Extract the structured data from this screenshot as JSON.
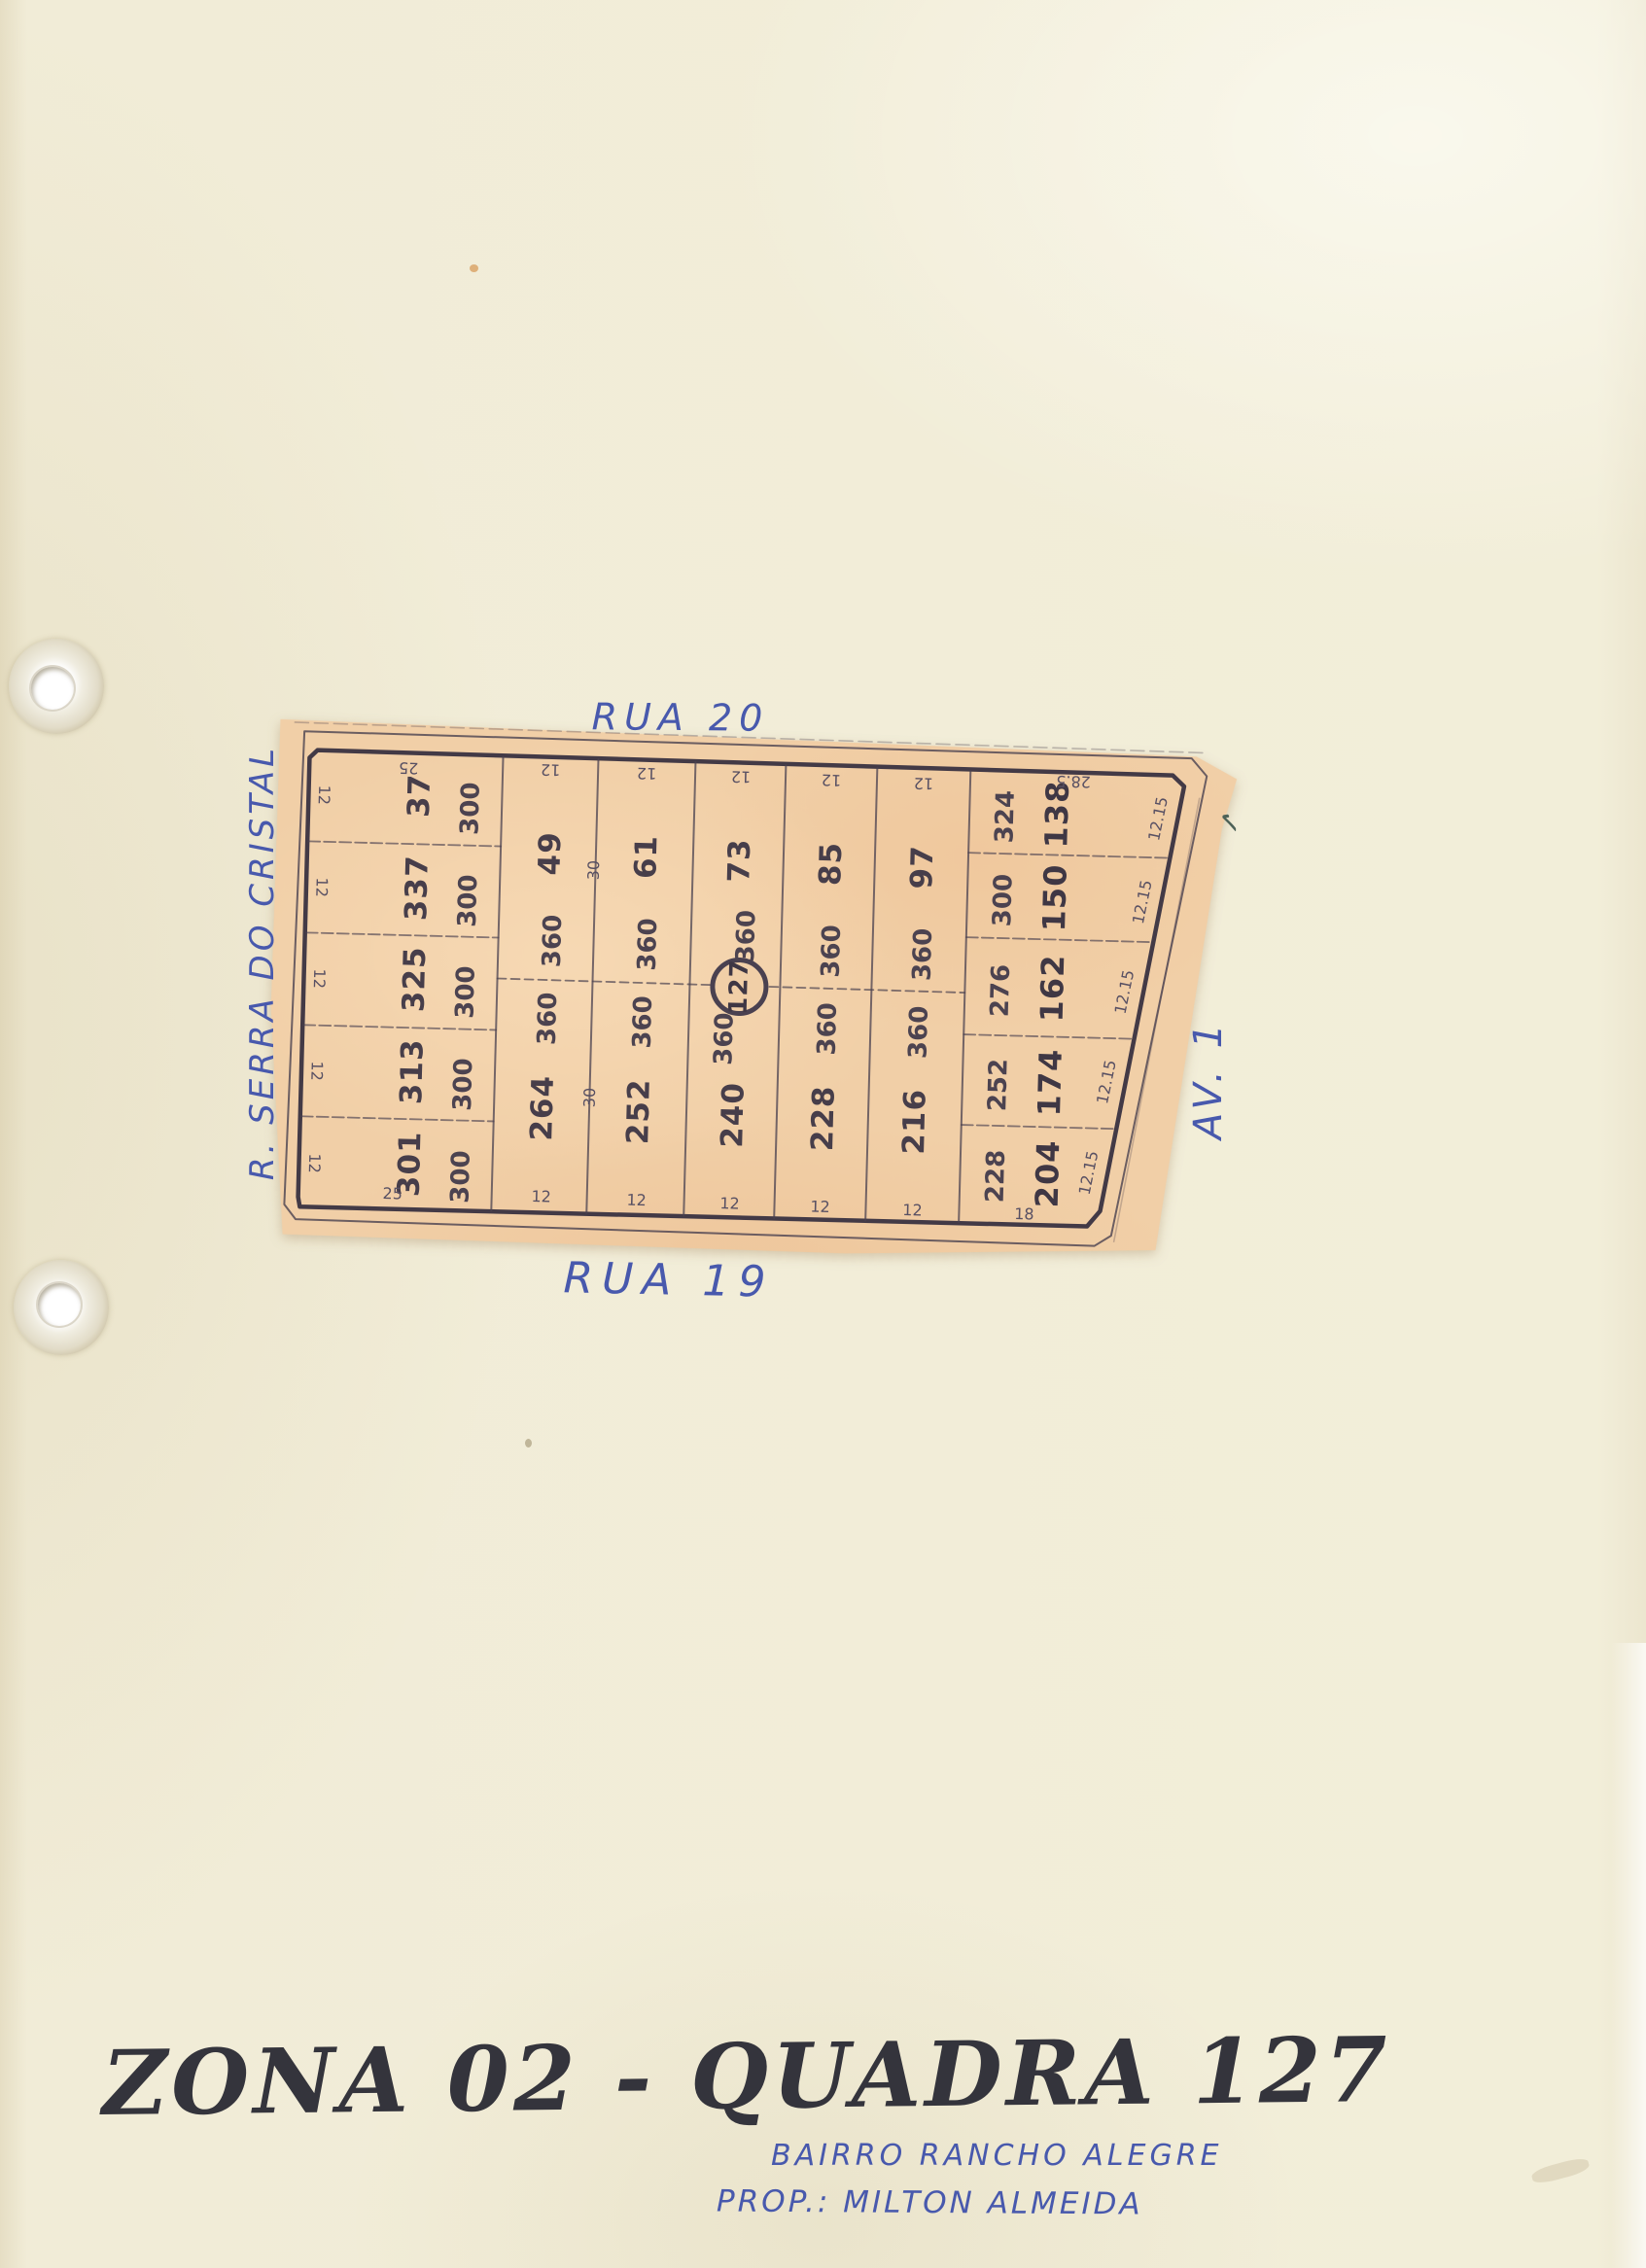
{
  "colors": {
    "page_background": "#f2eed9",
    "map_paper": "#f1cfa7",
    "draft_line": "#473e4a",
    "ink_blue": "#4859ad",
    "pencil_dark": "#34343c"
  },
  "streets": {
    "top": "RUA 20",
    "bottom": "RUA 19",
    "left": "R. SERRA DO CRISTAL",
    "right": "AV. 1"
  },
  "block": {
    "circled_number": "127"
  },
  "left_column": {
    "top_dim": "25",
    "bottom_dim": "25",
    "lots": [
      {
        "number": "37",
        "area": "300",
        "side_dim": "12"
      },
      {
        "number": "337",
        "area": "300",
        "side_dim": "12"
      },
      {
        "number": "325",
        "area": "300",
        "side_dim": "12"
      },
      {
        "number": "313",
        "area": "300",
        "side_dim": "12"
      },
      {
        "number": "301",
        "area": "300",
        "side_dim": "12"
      }
    ]
  },
  "strips": [
    {
      "top_dim": "12",
      "top_number": "49",
      "top_area": "360",
      "bottom_area": "360",
      "bottom_number": "264",
      "bottom_dim": "12"
    },
    {
      "top_dim": "12",
      "top_number": "61",
      "top_area": "360",
      "bottom_area": "360",
      "bottom_number": "252",
      "bottom_dim": "12"
    },
    {
      "top_dim": "12",
      "top_number": "73",
      "top_area": "360",
      "bottom_area": "360",
      "bottom_number": "240",
      "bottom_dim": "12"
    },
    {
      "top_dim": "12",
      "top_number": "85",
      "top_area": "360",
      "bottom_area": "360",
      "bottom_number": "228",
      "bottom_dim": "12"
    },
    {
      "top_dim": "12",
      "top_number": "97",
      "top_area": "360",
      "bottom_area": "360",
      "bottom_number": "216",
      "bottom_dim": "12"
    }
  ],
  "depth_dims": [
    "30",
    "30"
  ],
  "right_column": {
    "top_dim": "28.5",
    "bottom_dim": "18",
    "lots": [
      {
        "number": "138",
        "area": "324",
        "side_dim": "12.15"
      },
      {
        "number": "150",
        "area": "300",
        "side_dim": "12.15"
      },
      {
        "number": "162",
        "area": "276",
        "side_dim": "12.15"
      },
      {
        "number": "174",
        "area": "252",
        "side_dim": "12.15"
      },
      {
        "number": "204",
        "area": "228",
        "side_dim": "12.15"
      }
    ]
  },
  "annotations": {
    "tick_mark": "✓"
  },
  "footer": {
    "title": "ZONA 02 - QUADRA 127",
    "line1": "BAIRRO RANCHO ALEGRE",
    "line2": "PROP.: MILTON ALMEIDA"
  }
}
